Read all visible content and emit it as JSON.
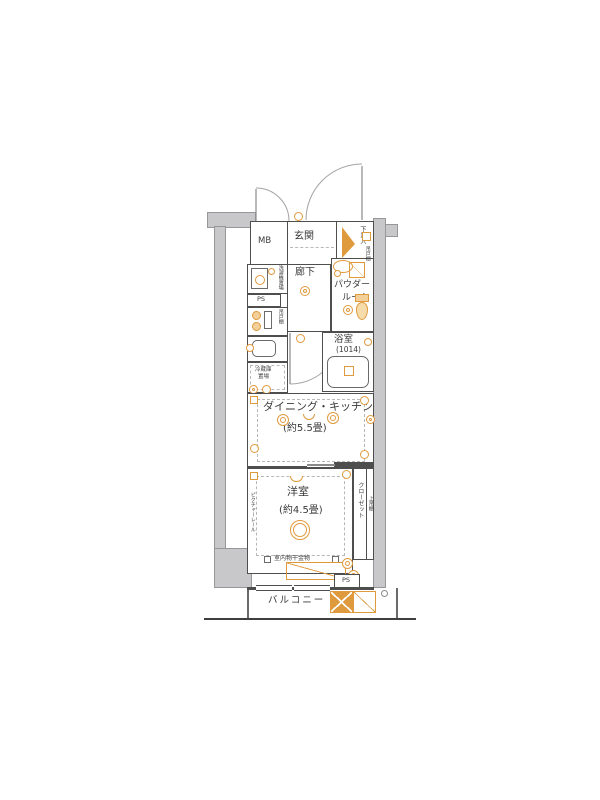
{
  "labels": {
    "mb": "MB",
    "entrance": "玄関",
    "shoe_box": "下足入",
    "hallway": "廊下",
    "powder_l1": "パウダー",
    "powder_l2": "ルーム",
    "bath": "浴室",
    "bath_size": "(1014)",
    "washer": "洗濯機置場",
    "ps_upper": "PS",
    "hanging_cupboard_kitchen": "吊戸棚",
    "hanging_cupboard_powder": "吊戸棚",
    "fridge_l1": "冷蔵庫",
    "fridge_l2": "置場",
    "dk": "ダイニング・キッチン",
    "dk_size": "(約5.5畳)",
    "bedroom": "洋室",
    "bedroom_size": "(約4.5畳)",
    "picture_rail": "ピクチャーレール",
    "closet": "クローゼット",
    "upper_shelf": "上吊棚",
    "laundry_hw": "室内物干金物",
    "ps_lower": "PS",
    "balcony": "バルコニー"
  },
  "colors": {
    "wall": "#c8c8cb",
    "wall_border": "#97979a",
    "line": "#4e4e4e",
    "accent": "#e09a3e",
    "dash": "#b8b8b8",
    "text": "#3a3a3a"
  },
  "icons": {
    "door_arc": "quarter-circle",
    "outlet": "small-orange-circle",
    "switch": "small-orange-square",
    "ceiling_light": "double-orange-circle",
    "stove_burner": "orange-circle",
    "sink": "rounded-rect",
    "washbasin": "orange-oval",
    "mirror_cabinet": "square-with-diagonal",
    "toilet": "tank-and-bowl",
    "bathtub": "rounded-rect-tub",
    "washing_machine": "square-with-circle",
    "shoe_wedge": "orange-triangle",
    "evac_hatch": "crossed-orange-rect",
    "laundry_bar": "orange-diagonal-rect"
  }
}
